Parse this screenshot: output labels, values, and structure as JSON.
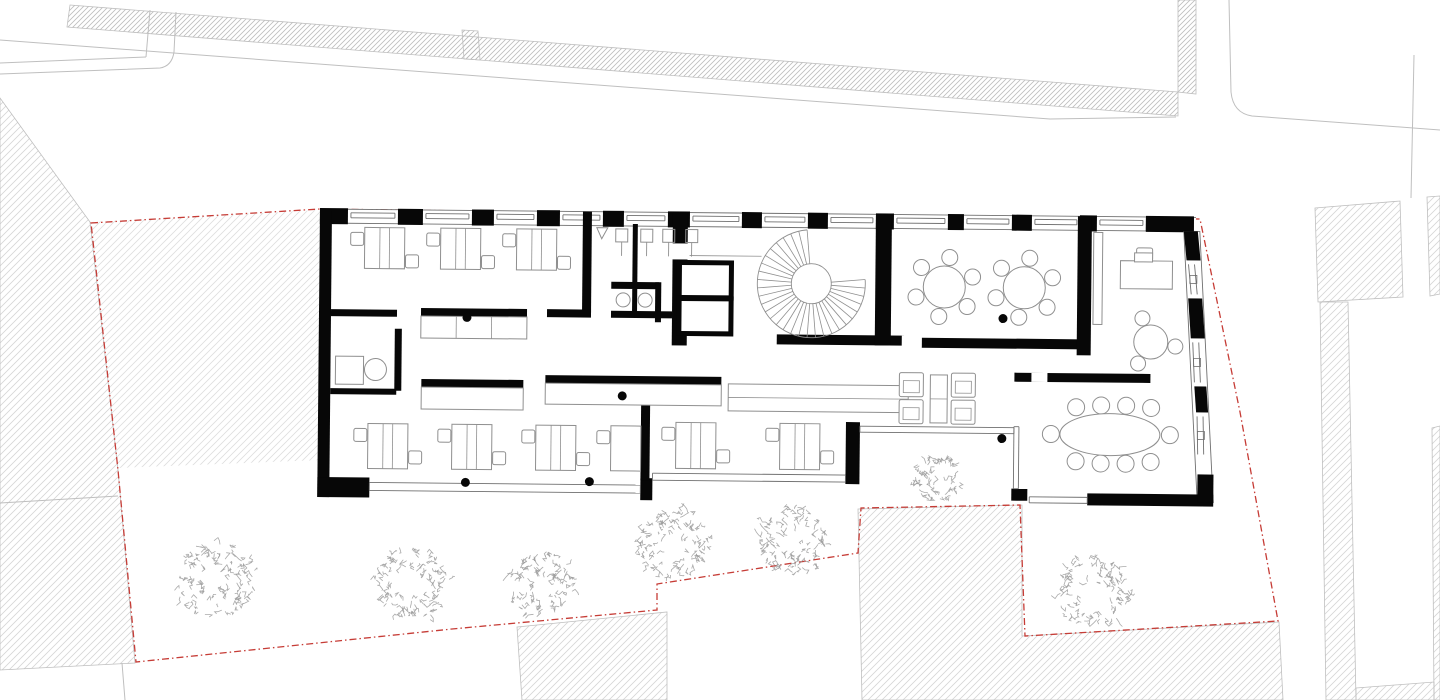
{
  "canvas": {
    "w": 1440,
    "h": 700,
    "bg": "#ffffff"
  },
  "palette": {
    "wall": "#070707",
    "window_line": "#6f6f6f",
    "furniture": "#8f8f8f",
    "context_line": "#bfbfbf",
    "hatch_dense": "#bdbdbd",
    "hatch_light": "#d6d6d6",
    "hatch_bg": "#f4f4f4",
    "boundary_red": "#c63c36",
    "tree": "#9b9b9b",
    "white": "#ffffff"
  },
  "context": {
    "dense_hatch_polys": [
      [
        [
          70,
          5
        ],
        [
          1178,
          92
        ],
        [
          1178,
          116
        ],
        [
          67,
          27
        ]
      ],
      [
        [
          1178,
          0
        ],
        [
          1196,
          0
        ],
        [
          1196,
          94
        ],
        [
          1178,
          92
        ]
      ],
      [
        [
          462,
          30
        ],
        [
          478,
          31
        ],
        [
          480,
          60
        ],
        [
          464,
          59
        ]
      ]
    ],
    "light_hatch_polys": [
      [
        [
          1315,
          208
        ],
        [
          1400,
          201
        ],
        [
          1403,
          297
        ],
        [
          1318,
          302
        ]
      ],
      [
        [
          1427,
          197
        ],
        [
          1440,
          196
        ],
        [
          1440,
          294
        ],
        [
          1430,
          296
        ]
      ],
      [
        [
          1320,
          302
        ],
        [
          1348,
          302
        ],
        [
          1356,
          700
        ],
        [
          1326,
          700
        ]
      ],
      [
        [
          1432,
          428
        ],
        [
          1440,
          426
        ],
        [
          1440,
          700
        ],
        [
          1434,
          700
        ]
      ],
      [
        [
          1356,
          688
        ],
        [
          1434,
          682
        ],
        [
          1434,
          700
        ],
        [
          1356,
          700
        ]
      ],
      [
        [
          517,
          627
        ],
        [
          667,
          612
        ],
        [
          667,
          700
        ],
        [
          522,
          700
        ]
      ],
      [
        [
          858,
          509
        ],
        [
          1022,
          505
        ],
        [
          1022,
          636
        ],
        [
          1279,
          622
        ],
        [
          1283,
          700
        ],
        [
          862,
          700
        ]
      ],
      [
        [
          0,
          98
        ],
        [
          90,
          222
        ],
        [
          118,
          470
        ],
        [
          135,
          663
        ],
        [
          0,
          670
        ]
      ]
    ],
    "yard_hatch_poly": [
      [
        91,
        222
      ],
      [
        320,
        210
      ],
      [
        322,
        460
      ],
      [
        118,
        468
      ]
    ],
    "lines": [
      [
        0,
        63,
        146,
        57
      ],
      [
        146,
        57,
        150,
        10
      ],
      [
        1414,
        55,
        1411,
        198
      ],
      [
        122,
        663,
        125,
        700
      ],
      [
        0,
        503,
        118,
        496
      ]
    ],
    "paths": [
      "M0,74 L160,68 Q172,66 174,52 L176,12",
      "M0,40 L1050,119 L1176,117",
      "M1229,0 L1231,92 Q1233,113 1252,116 L1440,130"
    ]
  },
  "boundary": {
    "points": [
      [
        91,
        223
      ],
      [
        320,
        209
      ],
      [
        700,
        214
      ],
      [
        1200,
        219
      ],
      [
        1240,
        412
      ],
      [
        1278,
        621
      ],
      [
        1025,
        636
      ],
      [
        1020,
        505
      ],
      [
        861,
        508
      ],
      [
        858,
        553
      ],
      [
        657,
        584
      ],
      [
        657,
        610
      ],
      [
        452,
        629
      ],
      [
        136,
        662
      ],
      [
        118,
        470
      ]
    ],
    "closed": true,
    "dash": "7 3 1.5 3",
    "width": 1.3
  },
  "trees": [
    {
      "cx": 216,
      "cy": 581,
      "r": 40
    },
    {
      "cx": 412,
      "cy": 583,
      "r": 38
    },
    {
      "cx": 541,
      "cy": 584,
      "r": 34
    },
    {
      "cx": 675,
      "cy": 545,
      "r": 37
    },
    {
      "cx": 792,
      "cy": 540,
      "r": 36
    },
    {
      "cx": 938,
      "cy": 478,
      "r": 24
    },
    {
      "cx": 1093,
      "cy": 592,
      "r": 37
    }
  ],
  "building": {
    "rotation": 0.55,
    "pivot": [
      320,
      209
    ],
    "footprint": [
      [
        320,
        209
      ],
      [
        1196,
        209
      ],
      [
        1218,
        496
      ],
      [
        1022,
        496
      ],
      [
        1022,
        420
      ],
      [
        862,
        420
      ],
      [
        862,
        498
      ],
      [
        320,
        498
      ]
    ],
    "north_wall": {
      "x1": 320,
      "x2": 1196,
      "y_top": 209,
      "y_bot": 223,
      "pillar_y": 208,
      "pillar_h": 16,
      "pillars": [
        [
          320,
          348
        ],
        [
          398,
          423
        ],
        [
          472,
          494
        ],
        [
          537,
          560
        ],
        [
          603,
          624
        ],
        [
          668,
          690
        ],
        [
          742,
          762
        ],
        [
          808,
          828
        ],
        [
          876,
          894
        ],
        [
          948,
          964
        ],
        [
          1012,
          1032
        ],
        [
          1080,
          1097
        ],
        [
          1146,
          1194
        ]
      ],
      "sill_y1": 212.5,
      "sill_y2": 217.5
    },
    "east_wall": {
      "band": [
        [
          1184,
          223
        ],
        [
          1200,
          223
        ],
        [
          1216,
          494
        ],
        [
          1200,
          494
        ]
      ],
      "chunks": [
        [
          [
            1184,
            223
          ],
          [
            1198,
            223
          ],
          [
            1201,
            252
          ],
          [
            1187,
            252
          ]
        ],
        [
          [
            1189,
            290
          ],
          [
            1203,
            290
          ],
          [
            1206,
            330
          ],
          [
            1192,
            330
          ]
        ],
        [
          [
            1196,
            378
          ],
          [
            1208,
            378
          ],
          [
            1210,
            404
          ],
          [
            1198,
            404
          ]
        ]
      ],
      "windows": [
        [
          1189,
          256,
          1192,
          286
        ],
        [
          1194,
          334,
          1196,
          374
        ],
        [
          1199,
          408,
          1200,
          446
        ]
      ]
    },
    "wall_rects": [
      [
        320,
        209,
        12,
        288
      ],
      [
        320,
        477,
        52,
        20
      ],
      [
        643,
        475,
        12,
        22
      ],
      [
        848,
        417,
        14,
        62
      ],
      [
        583,
        209,
        9,
        101
      ],
      [
        332,
        309,
        66,
        7
      ],
      [
        422,
        307,
        106,
        8
      ],
      [
        548,
        307,
        44,
        8
      ],
      [
        332,
        388,
        66,
        6
      ],
      [
        396,
        328,
        7,
        62
      ],
      [
        633,
        221,
        5,
        58
      ],
      [
        612,
        279,
        48,
        7
      ],
      [
        633,
        286,
        5,
        28
      ],
      [
        656,
        279,
        6,
        40
      ],
      [
        612,
        308,
        61,
        7
      ],
      [
        673,
        209,
        15,
        133
      ],
      [
        778,
        330,
        127,
        10
      ],
      [
        923,
        332,
        160,
        10
      ],
      [
        876,
        209,
        16,
        131
      ],
      [
        1078,
        209,
        14,
        139
      ],
      [
        423,
        378,
        102,
        8
      ],
      [
        547,
        373,
        176,
        8
      ],
      [
        643,
        389,
        9,
        88
      ],
      [
        1016,
        366,
        136,
        9
      ],
      [
        1090,
        486,
        126,
        12
      ],
      [
        1200,
        466,
        16,
        28
      ],
      [
        1014,
        482,
        16,
        12
      ],
      [
        1146,
        209,
        48,
        14
      ]
    ],
    "wall_gaps": [
      [
        671,
        240,
        19,
        16
      ],
      [
        903,
        330,
        20,
        12
      ],
      [
        1033,
        366,
        16,
        9
      ]
    ],
    "window_bands": [
      {
        "x1": 372,
        "x2": 643,
        "ya": 482,
        "yb": 490,
        "vertical": false
      },
      {
        "x1": 655,
        "x2": 848,
        "ya": 470,
        "yb": 477,
        "vertical": false
      },
      {
        "x1": 862,
        "x2": 1016,
        "ya": 421,
        "yb": 427,
        "vertical": false
      },
      {
        "x1": 420,
        "x2": 482,
        "ya": 1016,
        "yb": 1021,
        "vertical": true
      },
      {
        "x1": 1032,
        "x2": 1090,
        "ya": 490,
        "yb": 496,
        "vertical": false
      }
    ],
    "counters": [
      {
        "r": [
          422,
          315,
          106,
          22
        ],
        "ticks": 2
      },
      {
        "r": [
          423,
          386,
          102,
          22
        ],
        "ticks": 0
      },
      {
        "r": [
          547,
          381,
          176,
          21
        ],
        "ticks": 0
      },
      {
        "r": [
          730,
          380,
          180,
          27
        ],
        "midline": true
      },
      {
        "r": [
          337,
          356,
          28,
          28
        ]
      },
      {
        "r": [
          1094,
          225,
          9,
          92
        ]
      }
    ],
    "thick_rooms": [
      [
        680,
        259,
        52,
        35
      ],
      [
        680,
        295,
        52,
        35
      ]
    ],
    "desk_groups": [
      {
        "y": 227,
        "h": 41,
        "w": 40,
        "items": [
          {
            "x": 365,
            "cl": [
              351,
              232
            ],
            "cr": [
              406,
              254
            ]
          },
          {
            "x": 441,
            "cl": [
              427,
              232
            ],
            "cr": [
              482,
              254
            ]
          },
          {
            "x": 517,
            "cl": [
              503,
              232
            ],
            "cr": [
              558,
              254
            ]
          }
        ]
      },
      {
        "y": 423,
        "h": 45,
        "w": 40,
        "items": [
          {
            "x": 370,
            "cl": [
              356,
              428
            ],
            "cr": [
              411,
              450
            ]
          },
          {
            "x": 454,
            "cl": [
              440,
              428
            ],
            "cr": [
              495,
              450
            ]
          },
          {
            "x": 538,
            "cl": [
              524,
              428
            ],
            "cr": [
              579,
              450
            ]
          },
          {
            "x": 613,
            "w": 30,
            "cl": [
              599,
              428
            ]
          }
        ]
      },
      {
        "y": 419,
        "h": 46,
        "w": 40,
        "items": [
          {
            "x": 678,
            "cl": [
              664,
              424
            ],
            "cr": [
              719,
              446
            ]
          },
          {
            "x": 782,
            "cl": [
              768,
              424
            ],
            "cr": [
              823,
              446
            ]
          }
        ]
      }
    ],
    "chair_size": 13,
    "round_tables": [
      {
        "cx": 945,
        "cy": 281,
        "r": 21,
        "chair_r": 8,
        "dist": 30,
        "angles": [
          40,
          100,
          160,
          220,
          280,
          340
        ]
      },
      {
        "cx": 1025,
        "cy": 281,
        "r": 21,
        "chair_r": 8,
        "dist": 30,
        "angles": [
          40,
          100,
          160,
          220,
          280,
          340
        ]
      },
      {
        "cx": 1152,
        "cy": 334,
        "r": 17,
        "chair_r": 7.5,
        "dist": 25,
        "angles": [
          120,
          10,
          250
        ]
      }
    ],
    "exec_desk": {
      "desk": [
        1121,
        253,
        52,
        28
      ],
      "chair": [
        1137,
        240,
        16,
        13
      ],
      "monitor": [
        1135,
        245,
        18,
        9
      ]
    },
    "lounge": {
      "armchairs": [
        [
          901,
          367
        ],
        [
          953,
          367
        ],
        [
          901,
          394
        ],
        [
          953,
          394
        ]
      ],
      "armchair_size": 24,
      "coffee_table": [
        932,
        369,
        17,
        48
      ]
    },
    "meeting_table": {
      "cx": 1112,
      "cy": 427,
      "rx": 50,
      "ry": 21,
      "chairs": [
        [
          1078,
          400
        ],
        [
          1103,
          398
        ],
        [
          1128,
          398
        ],
        [
          1153,
          400
        ],
        [
          1078,
          454
        ],
        [
          1103,
          456
        ],
        [
          1128,
          456
        ],
        [
          1153,
          454
        ],
        [
          1053,
          427
        ],
        [
          1172,
          427
        ]
      ],
      "chair_r": 8.5
    },
    "wc": {
      "fixtures_x": [
        616,
        641,
        663,
        686
      ],
      "fixture_y": 226,
      "fixture_w": 12,
      "fixture_h": 13,
      "stem_len": 14,
      "door_triangle": [
        [
          597,
          225
        ],
        [
          608,
          225
        ],
        [
          602,
          236
        ]
      ],
      "sinks": [
        [
          624,
          297
        ],
        [
          646,
          297
        ]
      ],
      "sink_r": 7
    },
    "stair": {
      "cx": 812,
      "cy": 279,
      "r_in": 20,
      "r_out": 54,
      "a_start": -5,
      "a_end": 265,
      "step": 9,
      "landing_line": [
        690,
        252,
        762,
        252
      ]
    },
    "columns": [
      [
        468,
        316
      ],
      [
        468,
        481
      ],
      [
        592,
        479
      ],
      [
        624,
        393
      ],
      [
        1004,
        312
      ],
      [
        1004,
        432
      ]
    ],
    "column_r": 4.5
  }
}
